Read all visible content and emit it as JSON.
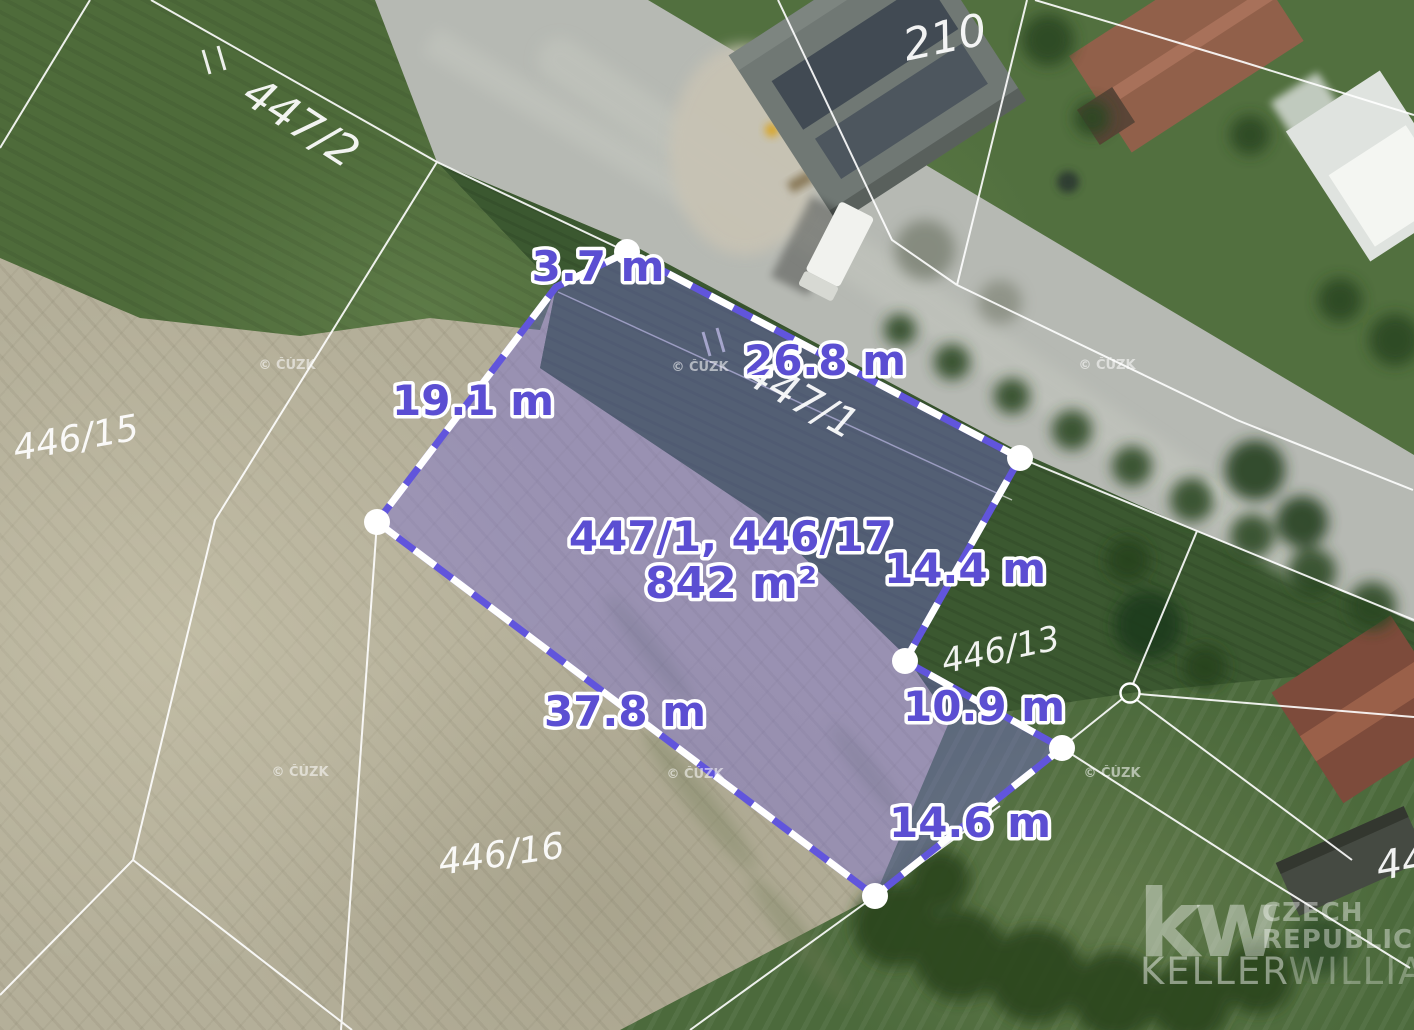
{
  "map": {
    "highlight": {
      "parcel_ids": "447/1, 446/17",
      "area": "842 m²",
      "edges": [
        "3.7 m",
        "26.8 m",
        "19.1 m",
        "14.4 m",
        "10.9 m",
        "37.8 m",
        "14.6 m"
      ],
      "colors": {
        "fill": "#7468d4",
        "border": "#6155dc",
        "label": "#5b4ed2",
        "outline": "#ffffff"
      }
    },
    "parcel_labels": [
      "447/2",
      "446/15",
      "446/16",
      "446/13",
      "447/1",
      "210",
      "44"
    ],
    "watermark": "© ČÚZK",
    "logo": {
      "monogram": "kw",
      "country_line1": "CZECH",
      "country_line2": "REPUBLIC",
      "brand_bold": "KELLER",
      "brand_light": "WILLIAMS."
    }
  }
}
